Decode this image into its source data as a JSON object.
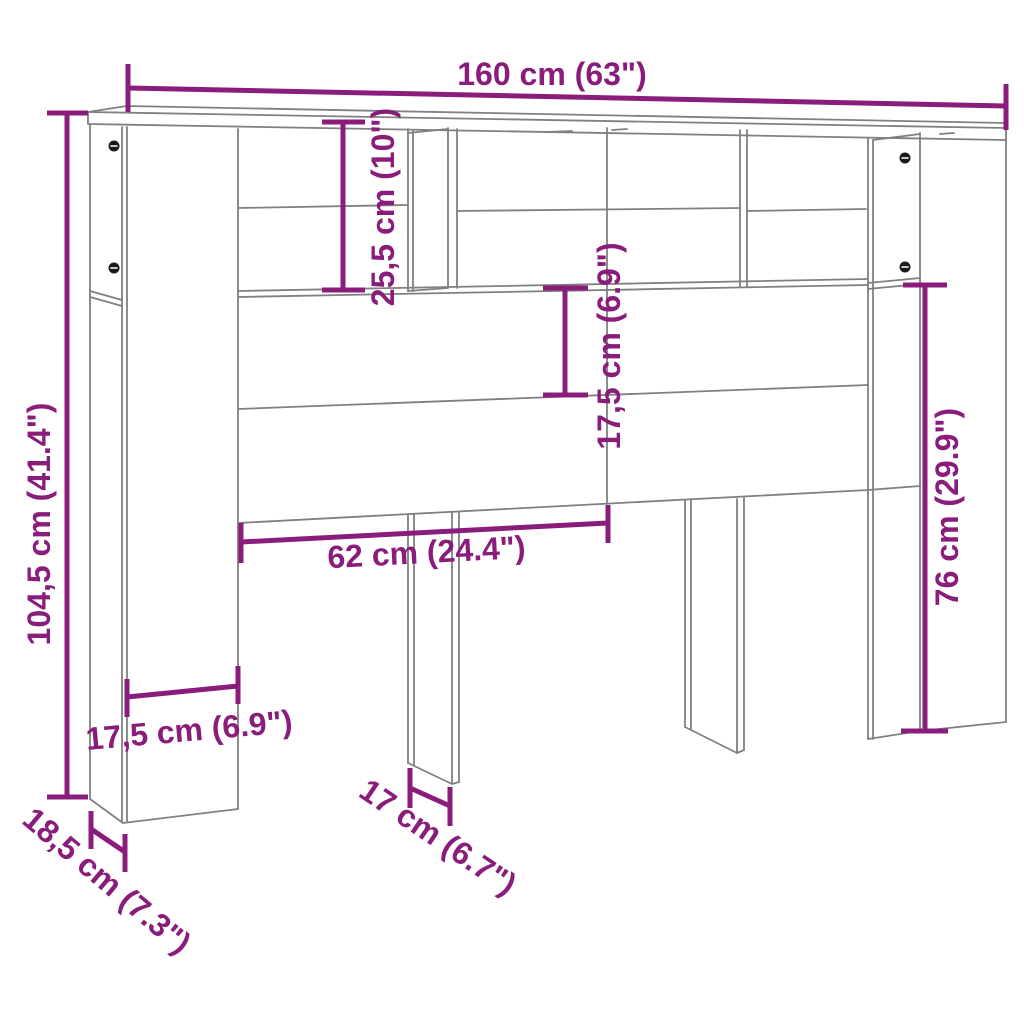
{
  "diagram": {
    "colors": {
      "dimension_accent": "#8a1c7c",
      "outline_gray": "#808080",
      "screw_black": "#1a1a1a",
      "background": "#ffffff"
    },
    "dimensions": {
      "total_width": "160 cm (63\")",
      "total_height": "104,5 cm (41.4\")",
      "top_shelf_height": "25,5 cm (10\")",
      "upper_panel_height": "17,5 cm (6.9\")",
      "side_panel_height": "76 cm (29.9\")",
      "half_width": "62 cm (24.4\")",
      "column_width": "17,5 cm (6.9\")",
      "leg_width": "17 cm (6.7\")",
      "depth": "18,5 cm (7.3\")"
    }
  }
}
